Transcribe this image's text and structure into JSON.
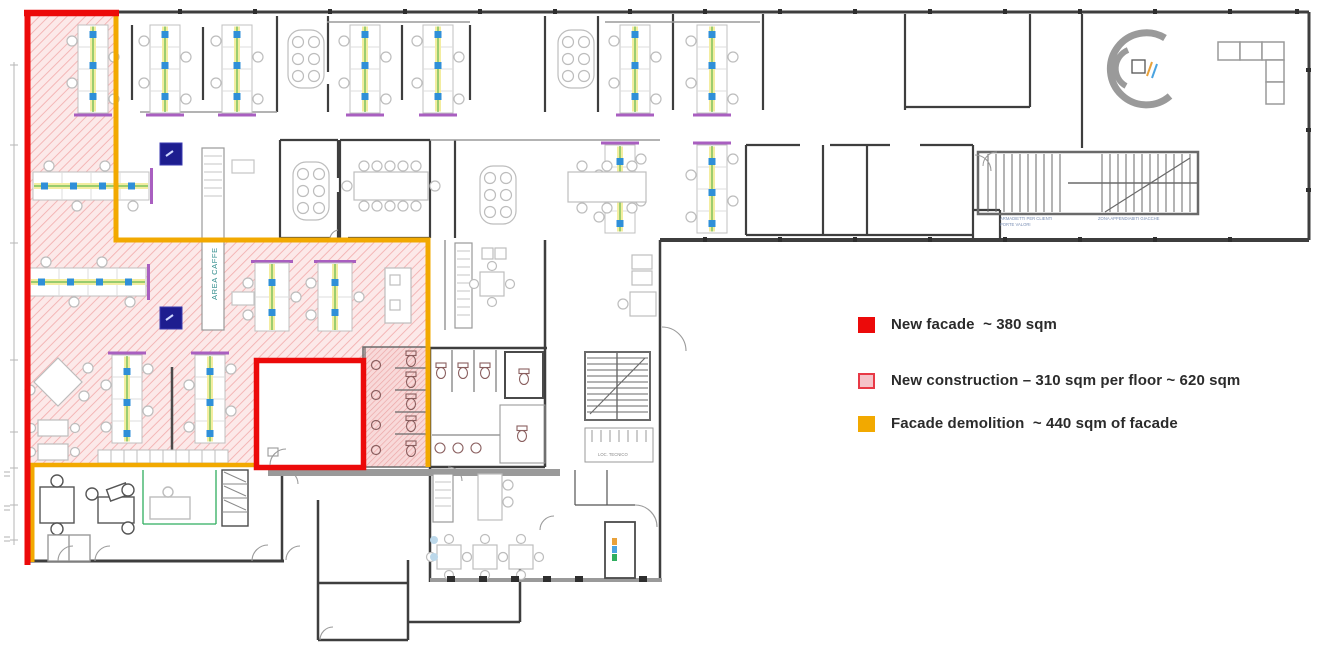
{
  "legend": {
    "items": [
      {
        "id": "new-facade",
        "label": "New facade  ~ 380 sqm",
        "swatch_fill": "#ec0a0a",
        "swatch_border": "#ec0a0a"
      },
      {
        "id": "new-construction",
        "label": "New construction – 310 sqm per floor ~ 620 sqm",
        "swatch_fill": "#f5c3c9",
        "swatch_border": "#e83946"
      },
      {
        "id": "facade-demolition",
        "label": "Facade demolition  ~ 440 sqm of facade",
        "swatch_fill": "#f2a900",
        "swatch_border": "#f2a900"
      }
    ]
  },
  "plan": {
    "labels": {
      "area_caffe": "AREA CAFFE",
      "lockers_line1": "ARMADIETTI PER CLIENTI",
      "lockers_line2": "PORTE VALORI",
      "coats": "ZONA APPENDIABITI GIACCHE",
      "tech_room": "LOC. TECNICO"
    },
    "colors": {
      "new_facade_red": "#ec0a0a",
      "construction_pink_bg": "#fce9e9",
      "construction_pink_stripe": "#f3b1b1",
      "demolition_yellow": "#f2a900",
      "wall_gray": "#3e3e3e",
      "furniture_gray": "#bdbdbd",
      "chair_blue": "#2f8fd8",
      "accent_purple": "#a95fc0",
      "accent_green": "#63b84f",
      "accent_navy": "#1d1d8f",
      "label_teal": "#2e8b8b"
    }
  }
}
